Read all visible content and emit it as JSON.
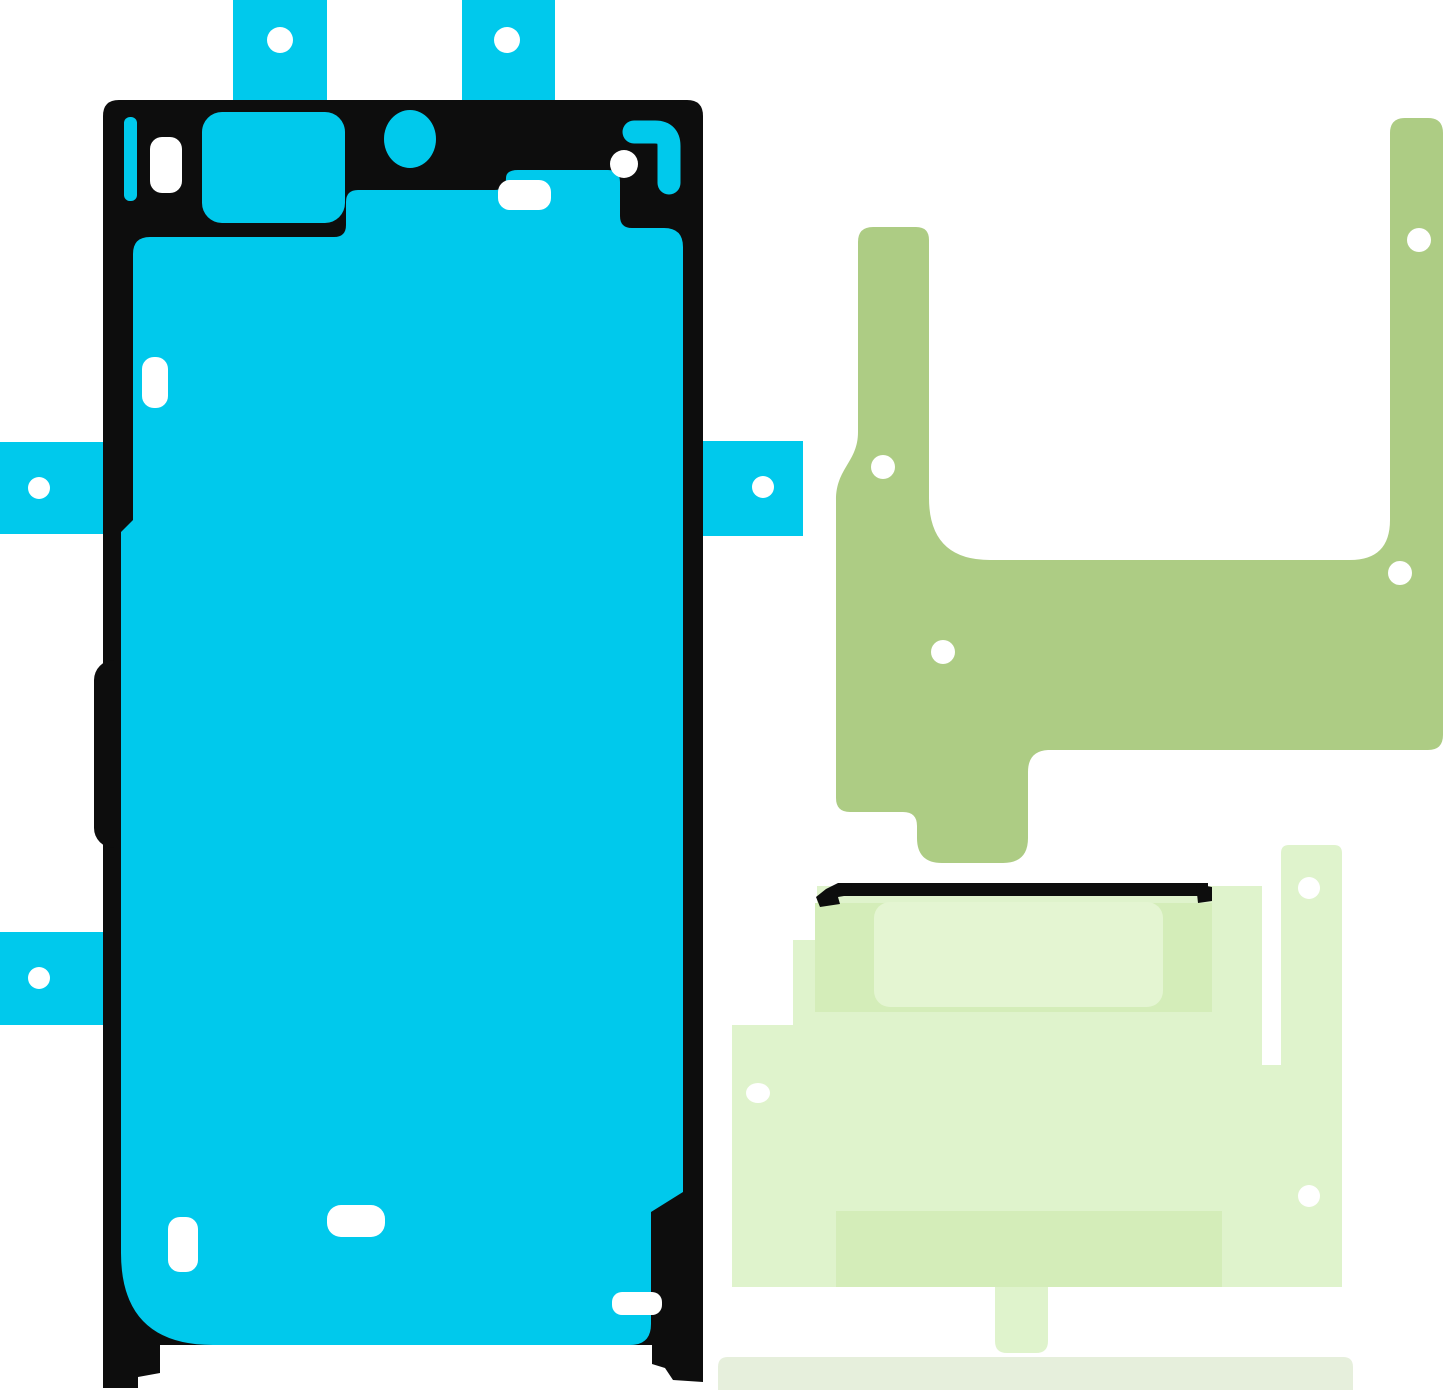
{
  "page": {
    "background": "#ffffff",
    "description": "Three die-cut adhesive tape sheets for a smartphone: cyan display adhesive with locating tabs, olive green frame adhesive bracket, pale green battery adhesive sheet with bottom pull strip"
  },
  "colors": {
    "white": "#ffffff",
    "black": "#0d0d0d",
    "cyan": "#00c9ec",
    "olive": "#adcc84",
    "pale": "#dff3cc",
    "pale_dark": "#d4edb9",
    "pale_light": "#e4f5d2",
    "strip": "#e6efdc"
  },
  "parts": {
    "display_adhesive": "display-adhesive-sticker",
    "frame_adhesive": "frame-adhesive-bracket",
    "battery_adhesive": "battery-adhesive-sheet",
    "pull_strip": "adhesive-pull-strip"
  }
}
